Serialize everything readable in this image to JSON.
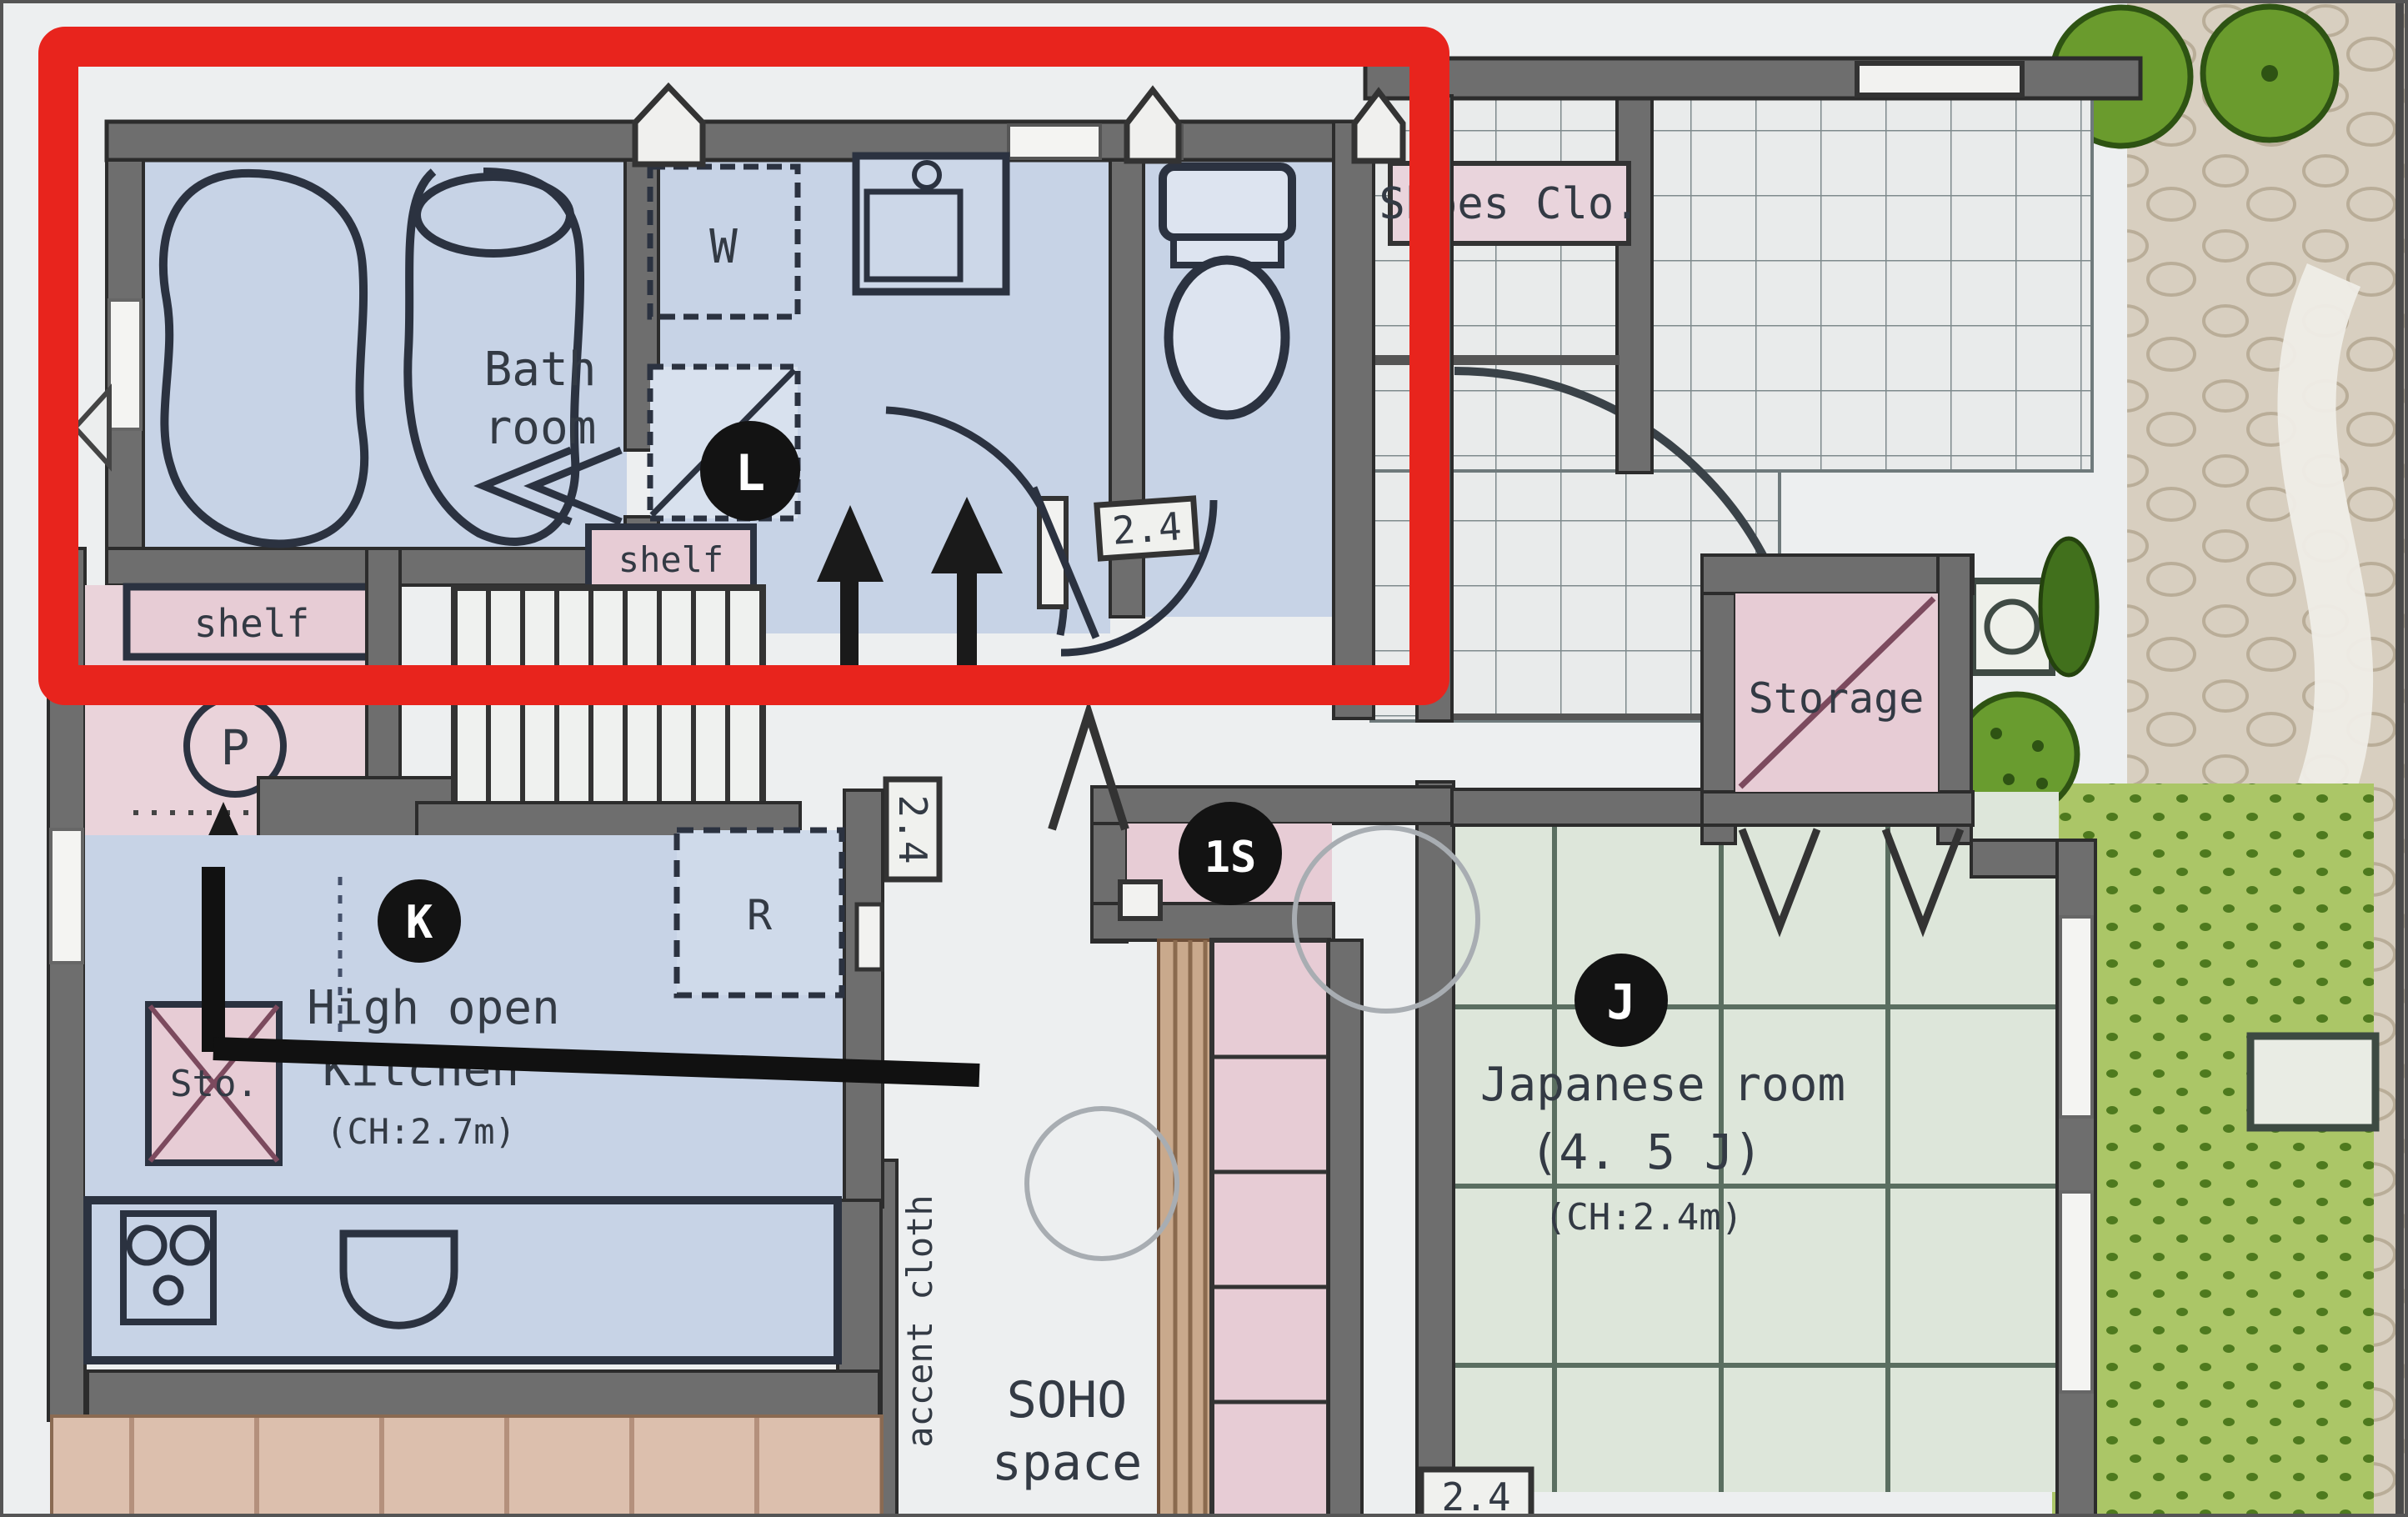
{
  "plan": {
    "highlight_color": "#e8241d",
    "rooms": {
      "bathroom": {
        "name_line1": "Bath",
        "name_line2": "room"
      },
      "washroom": {
        "washer_tag": "W",
        "tag": "L",
        "shelf_label": "shelf"
      },
      "toilet": {
        "width_label": "2.4"
      },
      "pantry": {
        "tag": "P",
        "shelf_label": "shelf"
      },
      "stairs": {
        "width_label": "2.4"
      },
      "kitchen": {
        "tag": "K",
        "name_line1": "High open",
        "name_line2": "Kitchen",
        "ceiling_height": "(CH:2.7m)",
        "fridge_tag": "R",
        "storage_label": "Sto."
      },
      "entrance": {
        "shoes_closet_label": "Shoes Clo."
      },
      "hall": {
        "tag": "1S",
        "soho_line1": "SOHO",
        "soho_line2": "space",
        "accent_label": "accent cloth"
      },
      "storage": {
        "name": "Storage"
      },
      "japanese_room": {
        "tag": "J",
        "name": "Japanese room",
        "size_label": "(4. 5 J)",
        "ceiling_height": "(CH:2.4m)",
        "width_label": "2.4"
      }
    }
  }
}
